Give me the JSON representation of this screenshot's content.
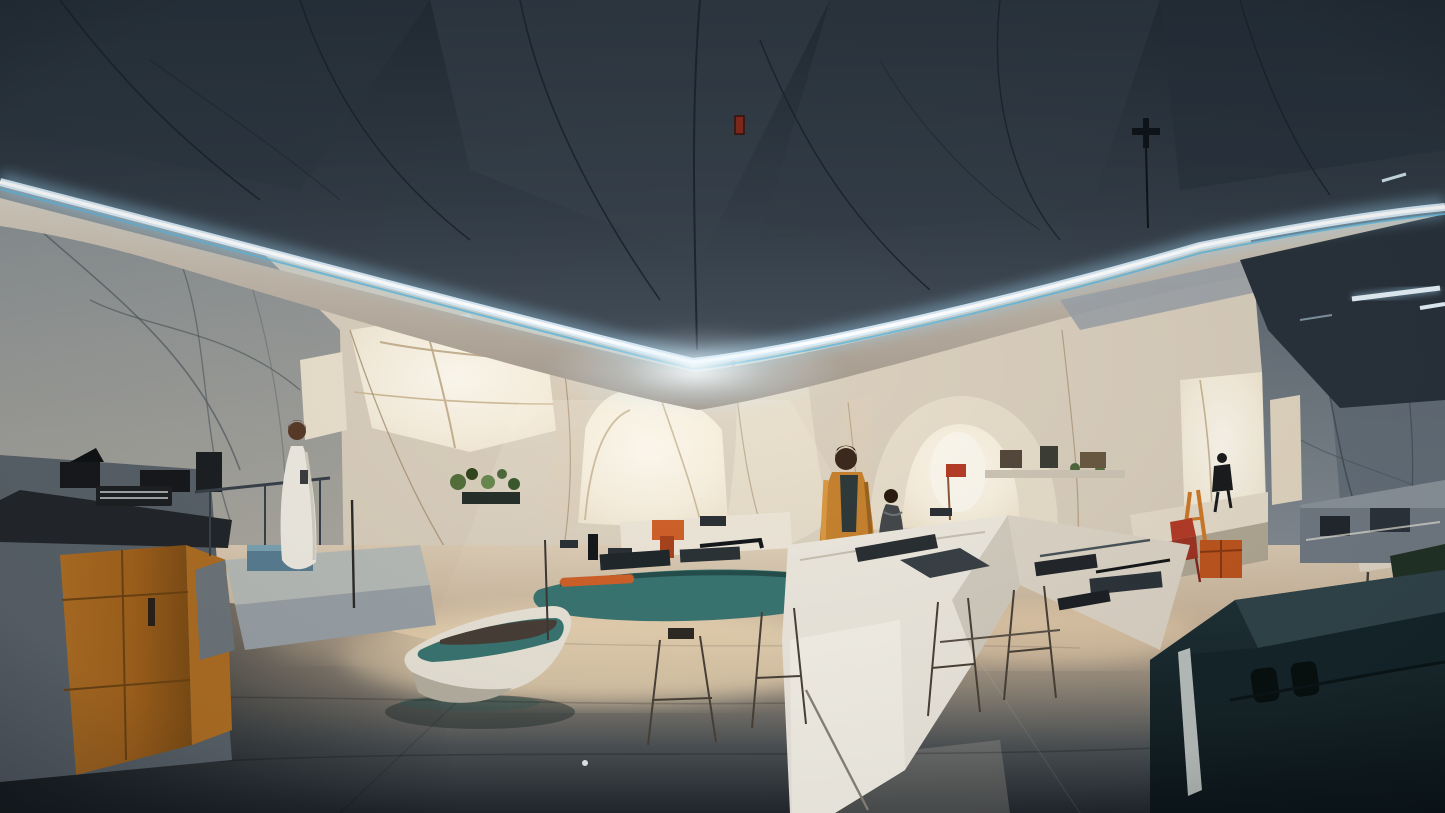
{
  "meta": {
    "kind": "concept-art-image",
    "subject": "futuristic organic cave-like studio interior, carved pale walls, glowing V-shaped LED ceiling strip, robed figures among sculptural workstations, polished reflective floor",
    "width_px": 1445,
    "height_px": 813
  },
  "palette": {
    "ceilingDark": "#222b34",
    "ceilingMid": "#39434e",
    "ceilingCrack": "#19212a",
    "ledGlow": "#9fd4f0",
    "ledMid": "#dceefb",
    "ledCore": "#ffffff",
    "ledCyan": "#5fb6dc",
    "beamLight": "#d7cec0",
    "wallCream": "#dbd0be",
    "windowGlow": "#f9f2e1",
    "leftWallGray": "#9aa09e",
    "rightWallGray": "#6e7781",
    "robeWhite": "#f1ede4",
    "robeOrange": "#c8832f",
    "robeOrangeLight": "#dc9a44",
    "skinDark": "#5a3b28",
    "hairDark": "#2e1d12",
    "cabinetWood": "#b06f24",
    "cabinetWoodDark": "#7e4d14",
    "counterDark": "#23272b",
    "tealCounter": "#3a7672",
    "tealDark": "#26514e",
    "accentOrange": "#d2622a",
    "accentRed": "#b63d27",
    "steelBlue": "#5b7f93",
    "plantGreen": "#55703c",
    "machineGray": "#727b84",
    "consoleDark": "#14252a",
    "floorWarm": "#ddccb4",
    "floorDark": "#21272d",
    "sunPool": "#f2dcb8"
  },
  "scene": {
    "lights": [
      {
        "name": "main-led-strip",
        "shape": "V-shaped band across ceiling",
        "color_ref": "ledCore"
      },
      {
        "name": "secondary-led-strip",
        "location": "upper right",
        "color_ref": "ledMid"
      }
    ],
    "figures": [
      {
        "name": "white-robed-figure",
        "location": "left, standing by steps",
        "color_ref": "robeWhite"
      },
      {
        "name": "orange-robed-figure",
        "location": "center, facing away",
        "color_ref": "robeOrange"
      },
      {
        "name": "companion-figure",
        "location": "center, beside orange-robed figure",
        "color_ref": "counterDark"
      },
      {
        "name": "distant-walking-figure",
        "location": "right ledge",
        "color_ref": "ceilingCrack"
      }
    ],
    "furniture": [
      {
        "name": "wood-cabinet",
        "location": "lower left",
        "color_ref": "cabinetWood"
      },
      {
        "name": "teal-lounge",
        "location": "center left",
        "color_ref": "tealCounter"
      },
      {
        "name": "teal-counter-long",
        "location": "center",
        "color_ref": "tealCounter"
      },
      {
        "name": "central-white-desk",
        "location": "center",
        "color_ref": "robeWhite"
      },
      {
        "name": "dark-console",
        "location": "lower right",
        "color_ref": "consoleDark"
      },
      {
        "name": "orange-chair-and-cabinet",
        "location": "mid right",
        "color_ref": "accentOrange"
      }
    ]
  }
}
